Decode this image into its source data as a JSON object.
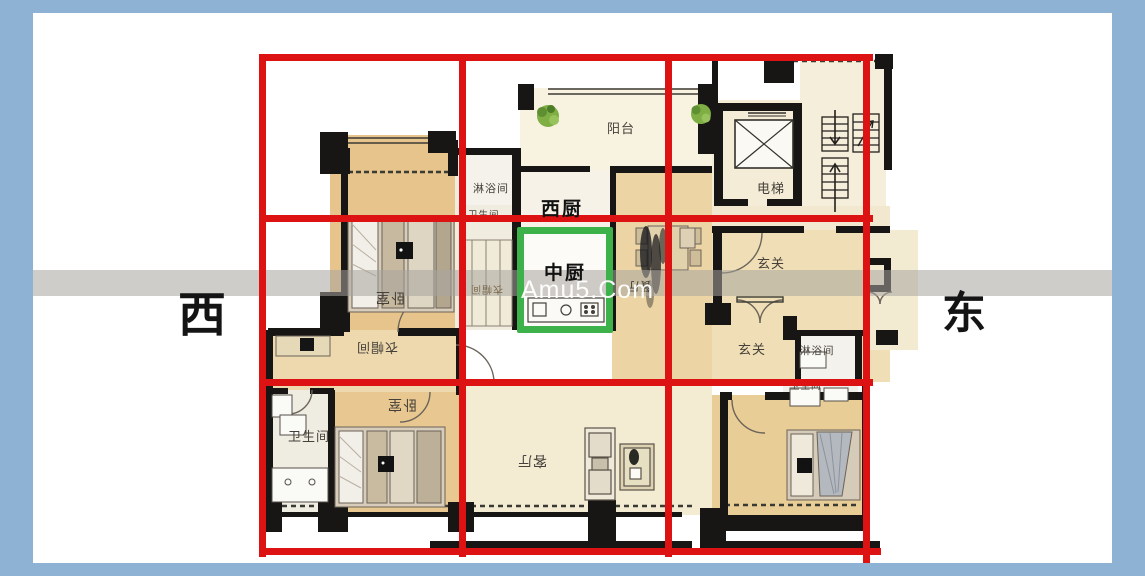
{
  "compass": {
    "west": "西",
    "east": "东"
  },
  "watermark": "Amu5.Com",
  "annotations": {
    "grid_color": "#dd1212",
    "highlight_color": "#3db24a",
    "frame_color": "#8eb2d4",
    "west_kitchen_label": "西厨",
    "middle_kitchen_label": "中厨"
  },
  "rooms": [
    {
      "id": "balcony",
      "label": "阳台"
    },
    {
      "id": "shower-1",
      "label": "淋浴间"
    },
    {
      "id": "utility-bath",
      "label": "卫生间"
    },
    {
      "id": "bedroom-tl",
      "label": "卧室"
    },
    {
      "id": "closet-2",
      "label": "衣帽间"
    },
    {
      "id": "dining",
      "label": "餐厅"
    },
    {
      "id": "elevator",
      "label": "电梯"
    },
    {
      "id": "foyer-1",
      "label": "玄关"
    },
    {
      "id": "foyer-2",
      "label": "玄关"
    },
    {
      "id": "shower-2",
      "label": "淋浴间"
    },
    {
      "id": "bath-2",
      "label": "卫生间"
    },
    {
      "id": "closet-1",
      "label": "衣帽间"
    },
    {
      "id": "bathroom-bl",
      "label": "卫生间"
    },
    {
      "id": "bedroom-bl",
      "label": "卧室"
    },
    {
      "id": "living",
      "label": "客厅"
    }
  ]
}
